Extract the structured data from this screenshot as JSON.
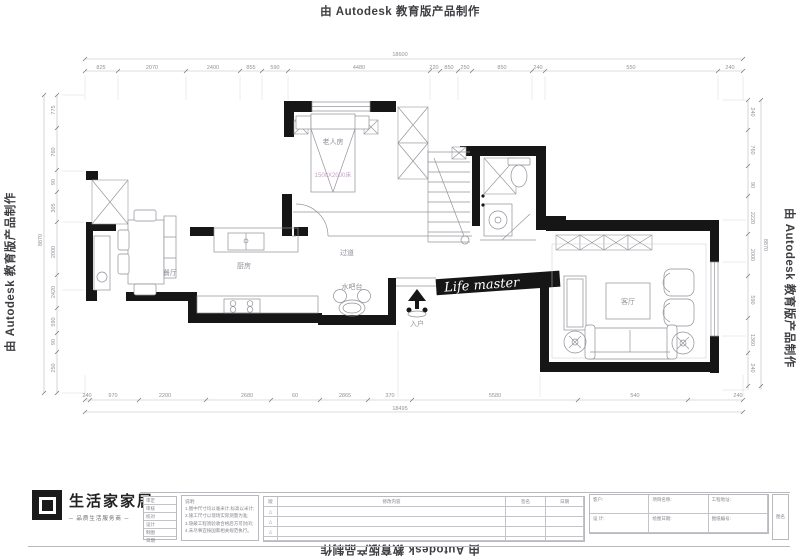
{
  "watermark": {
    "autodesk": "由 Autodesk 教育版产品制作"
  },
  "plan": {
    "labels": {
      "bedroom": "老人房",
      "bed_note": "1500X2000床",
      "dining": "餐厅",
      "kitchen": "厨房",
      "hallway": "过道",
      "water_bar": "水吧台",
      "entry": "入户",
      "living": "客厅"
    },
    "script_watermark": "Life master"
  },
  "dims": {
    "top_overall": "18600",
    "top": [
      "825",
      "2070",
      "2400",
      "855",
      "590",
      "4480",
      "220",
      "850",
      "250",
      "850",
      "240",
      "550",
      "240"
    ],
    "bottom": [
      "240",
      "970",
      "2200",
      "2680",
      "60",
      "2865",
      "370",
      "5580",
      "540",
      "240"
    ],
    "bottom_overall": "18495",
    "left": [
      "775",
      "760",
      "90",
      "305",
      "2000",
      "2420",
      "590",
      "90",
      "250"
    ],
    "left_overall": "8870",
    "right": [
      "240",
      "760",
      "90",
      "2220",
      "2000",
      "590",
      "1360",
      "240"
    ],
    "right_overall": "8870"
  },
  "logo": {
    "name": "生活家家居",
    "slogan": "─ 品质生活服务商 ─"
  },
  "titleblock": {
    "approval_rows": [
      "审定",
      "审核",
      "校对",
      "设计",
      "制图",
      "日期"
    ],
    "notes_title": "说明:",
    "notes_lines": [
      "1.图中尺寸均以毫米计,标高以米计;",
      "2.施工尺寸以现场实际测量为准;",
      "3.隐蔽工程须验收合格后方可封闭;",
      "4.未尽事宜按国家相关规范执行。"
    ],
    "rev_headers": [
      "版",
      "修改内容",
      "签名",
      "日期"
    ],
    "rev_mark": "△",
    "info_cells": [
      {
        "label": "客户:"
      },
      {
        "label": "项目名称:"
      },
      {
        "label": "工程地址:"
      },
      {
        "label": "设 计:"
      },
      {
        "label": "绘图日期:"
      },
      {
        "label": "图纸编号:"
      }
    ],
    "side_label": "图名"
  }
}
